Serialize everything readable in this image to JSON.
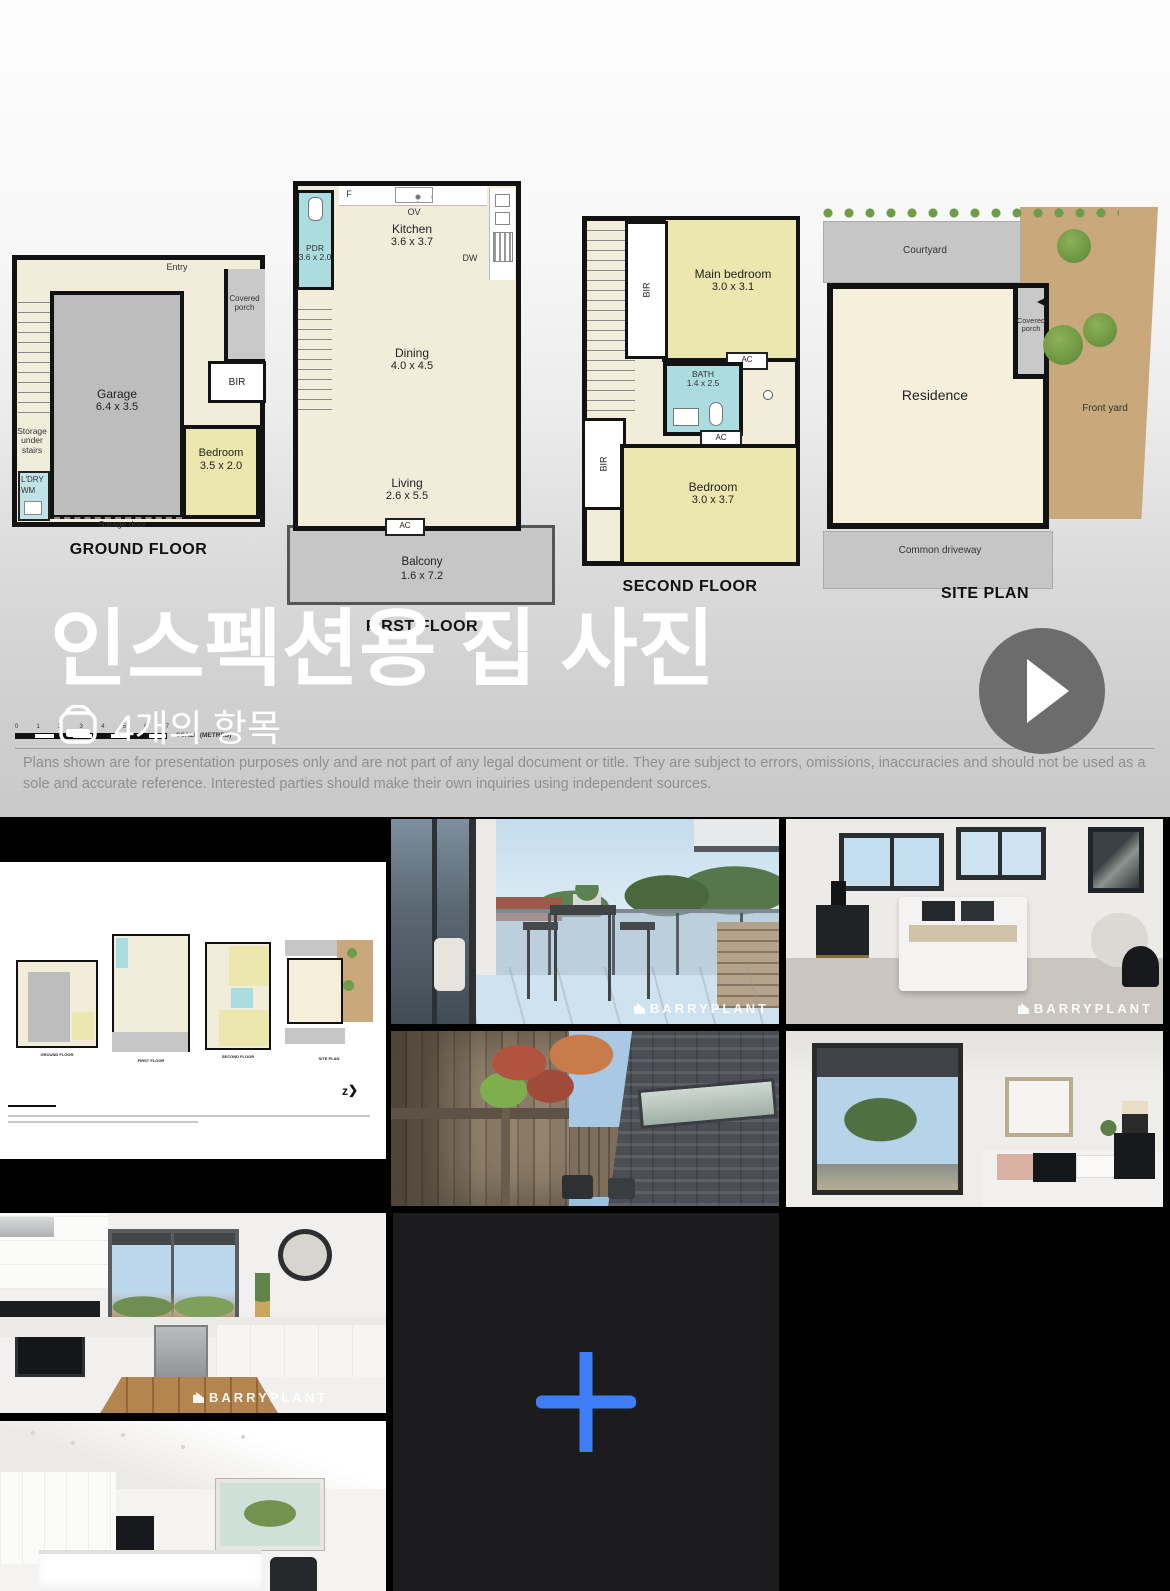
{
  "overlay": {
    "title": "인스펙션용 집 사진",
    "item_count": "4개의 항목"
  },
  "disclaimer": {
    "line1": "Plans shown are for presentation purposes only and are not part of any legal document or title. They are subject to errors, omissions, inaccuracies and should not be used as a sole and",
    "line2": "accurate reference. Interested parties should make their own inquiries using independent sources."
  },
  "watermark": "BARRYPLANT",
  "colors": {
    "accent_blue": "#3D7EF7",
    "plan_yellow": "#ECE7AE",
    "plan_cyan": "#ABDCE0",
    "plan_cream": "#F2ECDB",
    "plan_gray": "#BDBDBD",
    "site_tan": "#C9A87C",
    "play_gray": "#6C6C6C"
  },
  "plans": {
    "ground": {
      "title": "GROUND FLOOR",
      "garage_name": "Garage",
      "garage_dims": "6.4 x 3.5",
      "bedroom_name": "Bedroom",
      "bedroom_dims": "3.5 x 2.0",
      "entry": "Entry",
      "porch": "Covered porch",
      "bir": "BIR",
      "storage": "Storage under stairs",
      "ldry": "L'DRY",
      "wm": "WM",
      "garage_door": "Garage door"
    },
    "first": {
      "title": "FIRST FLOOR",
      "kitchen_name": "Kitchen",
      "kitchen_dims": "3.6 x 3.7",
      "pdr_name": "PDR",
      "pdr_dims": "3.6 x 2.0",
      "dining_name": "Dining",
      "dining_dims": "4.0 x 4.5",
      "living_name": "Living",
      "living_dims": "2.6 x 5.5",
      "balcony_name": "Balcony",
      "balcony_dims": "1.6 x 7.2",
      "f": "F",
      "ov": "OV",
      "dw": "DW",
      "ac": "AC"
    },
    "second": {
      "title": "SECOND FLOOR",
      "main_name": "Main bedroom",
      "main_dims": "3.0 x 3.1",
      "bath_name": "BATH",
      "bath_dims": "1.4 x 2.5",
      "bedroom_name": "Bedroom",
      "bedroom_dims": "3.0 x 3.7",
      "bir": "BIR",
      "ac": "AC"
    },
    "site": {
      "title": "SITE PLAN",
      "courtyard": "Courtyard",
      "porch": "Covered porch",
      "residence": "Residence",
      "front_yard": "Front yard",
      "driveway": "Common driveway"
    },
    "scale_label": "SCALE (METRES)",
    "scale_ticks": [
      "0",
      "1",
      "2",
      "3",
      "4",
      "5",
      "6",
      "7"
    ]
  }
}
